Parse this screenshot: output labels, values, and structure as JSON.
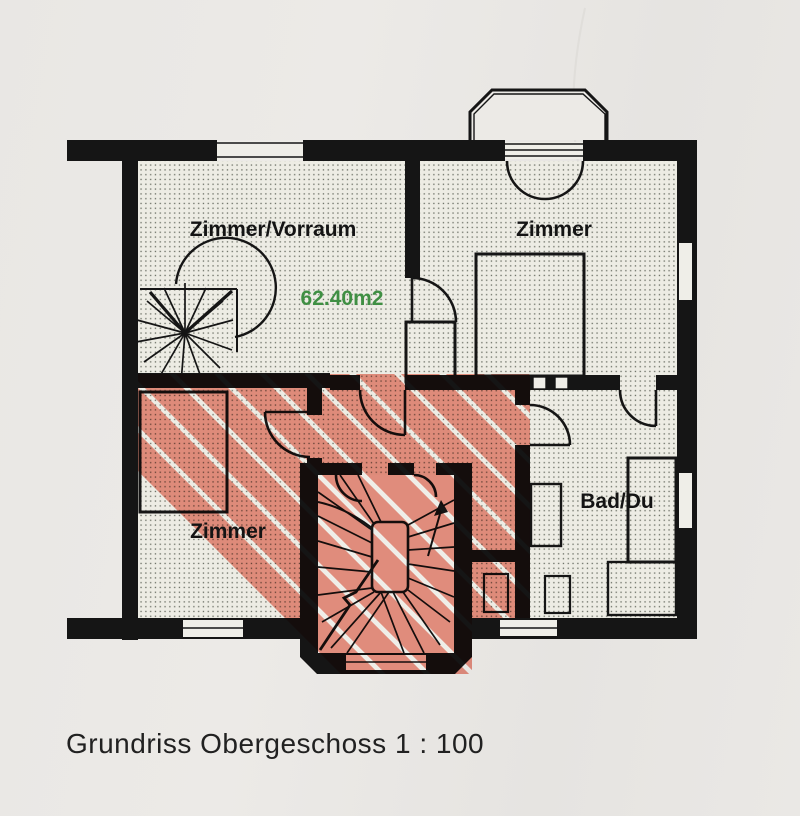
{
  "plan": {
    "title_caption": "Grundriss Obergeschoss 1 : 100",
    "area_label": "62.40m2",
    "rooms": [
      {
        "id": "zimmer-vorraum",
        "label": "Zimmer/Vorraum"
      },
      {
        "id": "zimmer-top-right",
        "label": "Zimmer"
      },
      {
        "id": "zimmer-bottom-left",
        "label": "Zimmer"
      },
      {
        "id": "bad-du",
        "label": "Bad/Du"
      }
    ],
    "colors": {
      "highlight_stripes": "#ec7f6e",
      "area_text": "#3f8f43",
      "wall": "#151515",
      "paper": "#e8e6e3",
      "floor": "#edece4"
    }
  }
}
